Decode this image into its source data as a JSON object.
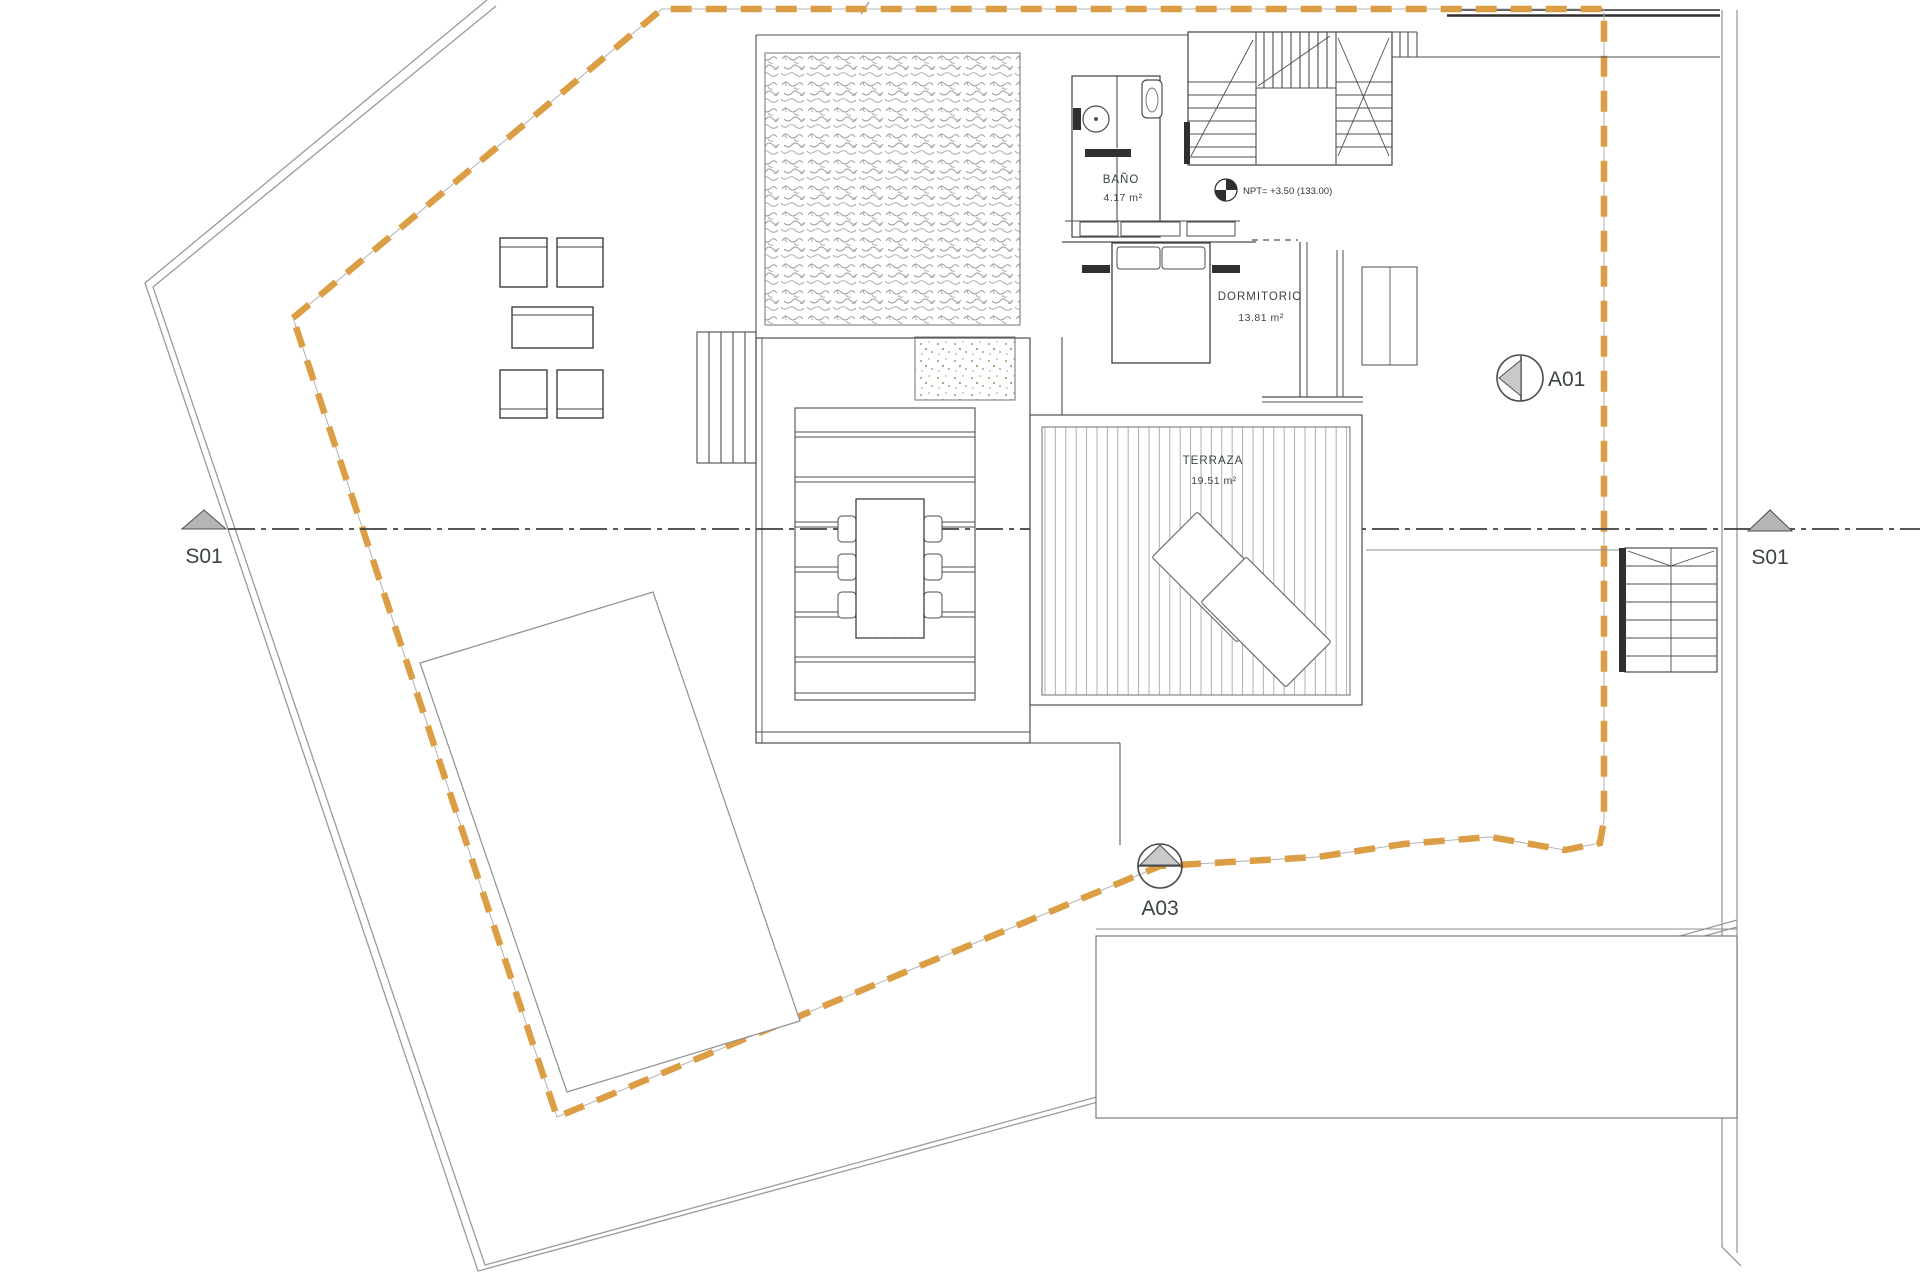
{
  "drawing": {
    "rooms": {
      "bathroom": {
        "label": "BAÑO",
        "area": "4.17 m²"
      },
      "bedroom": {
        "label": "DORMITORIO",
        "area": "13.81 m²"
      },
      "terrace": {
        "label": "TERRAZA",
        "area": "19.51 m²"
      }
    },
    "level_marker": {
      "text": "NPT= +3.50 (133.00)"
    },
    "section_markers": {
      "left": {
        "label": "S01"
      },
      "right": {
        "label": "S01"
      }
    },
    "view_markers": {
      "a01": {
        "label": "A01"
      },
      "a03": {
        "label": "A03"
      }
    },
    "colors": {
      "setback_dash": "#DC9E45",
      "boundary_gray": "#9A9A9A",
      "wall_dark": "#2F2F2F",
      "label_text": "#3A4446",
      "marker_fill": "#B5B5B5",
      "plant_green": "#9FAE85"
    }
  }
}
